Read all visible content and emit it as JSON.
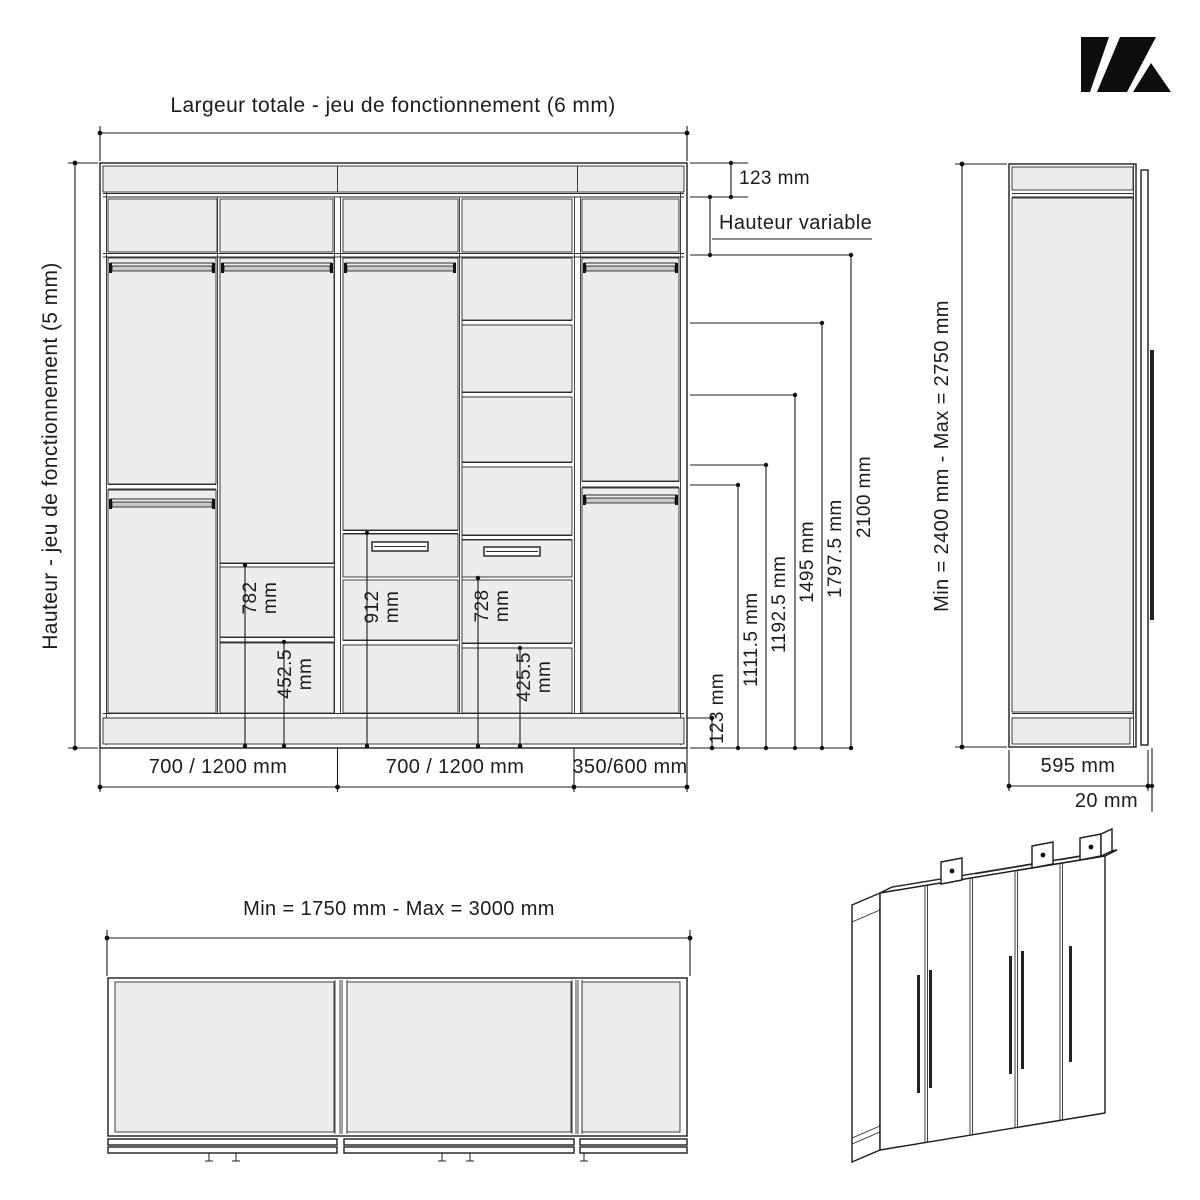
{
  "logo": {
    "name": "stylized-K-logo"
  },
  "front_view": {
    "title_top": "Largeur totale - jeu de fonctionnement (6 mm)",
    "title_left": "Hauteur - jeu de fonctionnement (5 mm)",
    "filler_top_dim": "123 mm",
    "hauteur_variable_label": "Hauteur variable",
    "plinth_dim": "123 mm",
    "height_dims": [
      "1111.5 mm",
      "1192.5 mm",
      "1495 mm",
      "1797.5 mm",
      "2100 mm"
    ],
    "interior_dims": [
      {
        "value": "782",
        "unit": "mm"
      },
      {
        "value": "452.5",
        "unit": "mm"
      },
      {
        "value": "912",
        "unit": "mm"
      },
      {
        "value": "728",
        "unit": "mm"
      },
      {
        "value": "425.5",
        "unit": "mm"
      }
    ],
    "width_dims": [
      "700 / 1200 mm",
      "700 / 1200 mm",
      "350/600 mm"
    ]
  },
  "side_view": {
    "height_range": "Min = 2400 mm - Max = 2750 mm",
    "depth": "595 mm",
    "door_thickness": "20 mm"
  },
  "plan_view": {
    "width_range": "Min = 1750 mm - Max = 3000 mm"
  }
}
